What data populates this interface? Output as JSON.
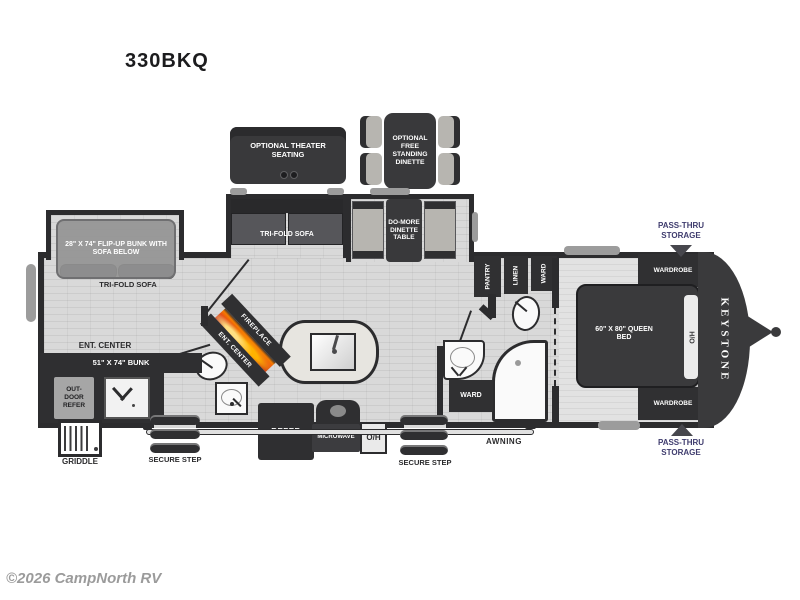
{
  "page": {
    "title": "330BKQ",
    "copyright": "©2026 CampNorth RV"
  },
  "options": {
    "theater_seating": "OPTIONAL THEATER SEATING",
    "free_standing_dinette": "OPTIONAL FREE STANDING DINETTE"
  },
  "slides": {
    "flip_up_bunk": "28\" X 74\" FLIP-UP BUNK WITH SOFA BELOW",
    "tri_fold_sofa": "TRI-FOLD SOFA",
    "dinette_table": "DO-MORE DINETTE TABLE"
  },
  "rear_living": {
    "ent_center": "ENT. CENTER",
    "bunk": "51\" X 74\" BUNK",
    "outdoor_refer": "OUT-DOOR REFER",
    "griddle": "GRIDDLE",
    "fireplace": "FIREPLACE"
  },
  "kitchen": {
    "refer": "REFER",
    "microwave": "MICROWAVE",
    "overhead": "O/H",
    "pantry": "PANTRY"
  },
  "bath": {
    "linen": "LINEN",
    "ward": "WARD"
  },
  "bedroom": {
    "wardrobe": "WARDROBE",
    "queen_bed": "60\" X 80\" QUEEN BED",
    "head_of_bed": "H/O",
    "brand": "KEYSTONE"
  },
  "exterior": {
    "pass_thru_storage": "PASS-THRU STORAGE",
    "awning": "AWNING",
    "secure_step": "SECURE STEP"
  },
  "colors": {
    "wall": "#2c2c2e",
    "floor": "#d9d9d9",
    "navy": "#3f3c6e",
    "flame": "#f26a1b"
  }
}
